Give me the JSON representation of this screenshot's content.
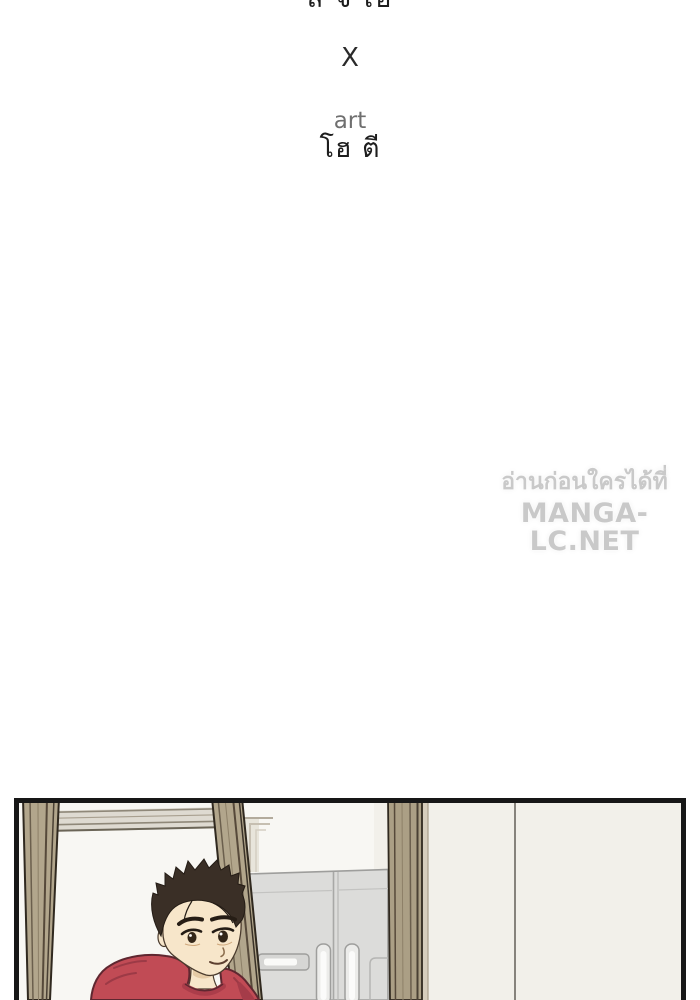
{
  "credits": {
    "author_name": "ล จ เฮ",
    "separator": "X",
    "role_label": "art",
    "artist_name": "โฮ ตี"
  },
  "watermark": {
    "tagline_thai": "อ่านก่อนใครได้ที่",
    "site_name": "MANGA-LC.NET"
  },
  "panel_scene": {
    "elements": [
      "left-door-jamb",
      "doorway-top-molding",
      "man-in-red-sweater",
      "middle-door-jamb",
      "door-frame-corner",
      "refrigerator",
      "right-door-jamb",
      "right-wall",
      "wall-seam-line",
      "panel-border"
    ],
    "colors": {
      "panel_border": "#171717",
      "doorway_wall": "#f8f7f3",
      "right_wall": "#f2f0ea",
      "wood_beam": "#b2a68c",
      "wood_beam_dark_line": "#56493a",
      "molding": "#dedad1",
      "fridge_body": "#dcdcda",
      "fridge_line": "#a3a3a1",
      "hair": "#3a2f26",
      "skin": "#f7e6ca",
      "sweater_red": "#c14b55",
      "sweater_shadow": "#a03c48"
    }
  }
}
